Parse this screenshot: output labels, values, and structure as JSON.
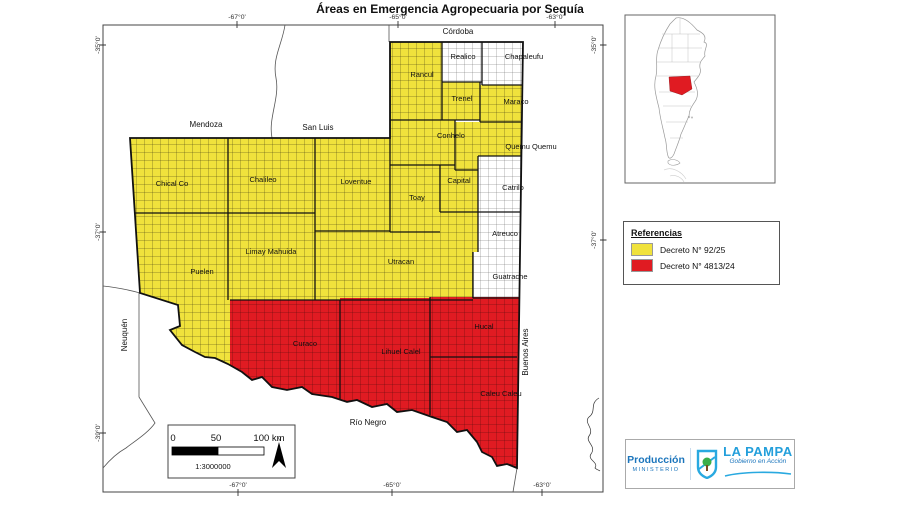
{
  "title": "Áreas en Emergencia Agropecuaria por Sequía",
  "colors": {
    "yellow": "#F0E23C",
    "red": "#E01B22",
    "logo_blue": "#1B75BC",
    "logo_lightblue": "#29A9E0",
    "logo_green": "#3AAE49"
  },
  "map": {
    "departments": {
      "chical_co": {
        "label": "Chical Co",
        "status": "decreto_92_25"
      },
      "chalileo": {
        "label": "Chalileo",
        "status": "decreto_92_25"
      },
      "loventue": {
        "label": "Loventue",
        "status": "decreto_92_25"
      },
      "rancul": {
        "label": "Rancul",
        "status": "decreto_92_25"
      },
      "trenel": {
        "label": "Trenel",
        "status": "decreto_92_25"
      },
      "maraco": {
        "label": "Maraco",
        "status": "decreto_92_25"
      },
      "conhelo": {
        "label": "Conhelo",
        "status": "decreto_92_25"
      },
      "quemu_quemu": {
        "label": "Quemu Quemu",
        "status": "decreto_92_25"
      },
      "toay": {
        "label": "Toay",
        "status": "decreto_92_25"
      },
      "capital": {
        "label": "Capital",
        "status": "decreto_92_25"
      },
      "utracan": {
        "label": "Utracan",
        "status": "decreto_92_25"
      },
      "limay_mahuida": {
        "label": "Limay Mahuida",
        "status": "decreto_92_25"
      },
      "puelen": {
        "label": "Puelen",
        "status": "decreto_92_25"
      },
      "realico": {
        "label": "Realico",
        "status": "none"
      },
      "chapaleufu": {
        "label": "Chapaleufu",
        "status": "none"
      },
      "catrilo": {
        "label": "Catrilo",
        "status": "none"
      },
      "atreuco": {
        "label": "Atreuco",
        "status": "none"
      },
      "guatrache": {
        "label": "Guatrache",
        "status": "none"
      },
      "curaco": {
        "label": "Curaco",
        "status": "decreto_4813_24"
      },
      "lihuel_calel": {
        "label": "Lihuel Calel",
        "status": "decreto_4813_24"
      },
      "hucal": {
        "label": "Hucal",
        "status": "decreto_4813_24"
      },
      "caleu_caleu": {
        "label": "Caleu Caleu",
        "status": "decreto_4813_24"
      }
    },
    "neighbors": {
      "cordoba": "Córdoba",
      "mendoza": "Mendoza",
      "san_luis": "San Luis",
      "neuquen": "Neuquén",
      "rio_negro": "Río Negro",
      "buenos_aires": "Buenos Aires"
    },
    "coordinates": {
      "lon_67": "-67°0'",
      "lon_65": "-65°0'",
      "lon_63": "-63°0'",
      "lat_35": "-35°0'",
      "lat_37": "-37°0'",
      "lat_39": "-39°0'"
    }
  },
  "legend": {
    "title": "Referencias",
    "items": [
      {
        "label": "Decreto N° 92/25",
        "color_key": "yellow"
      },
      {
        "label": "Decreto N° 4813/24",
        "color_key": "red"
      }
    ]
  },
  "scalebar": {
    "tick_0": "0",
    "tick_50": "50",
    "tick_100": "100 km",
    "ratio": "1:3000000",
    "north_label": "N"
  },
  "logo": {
    "org_name": "Producción",
    "org_subtitle": "MINISTERIO",
    "province_name": "LA PAMPA",
    "slogan": "Gobierno en Acción"
  }
}
